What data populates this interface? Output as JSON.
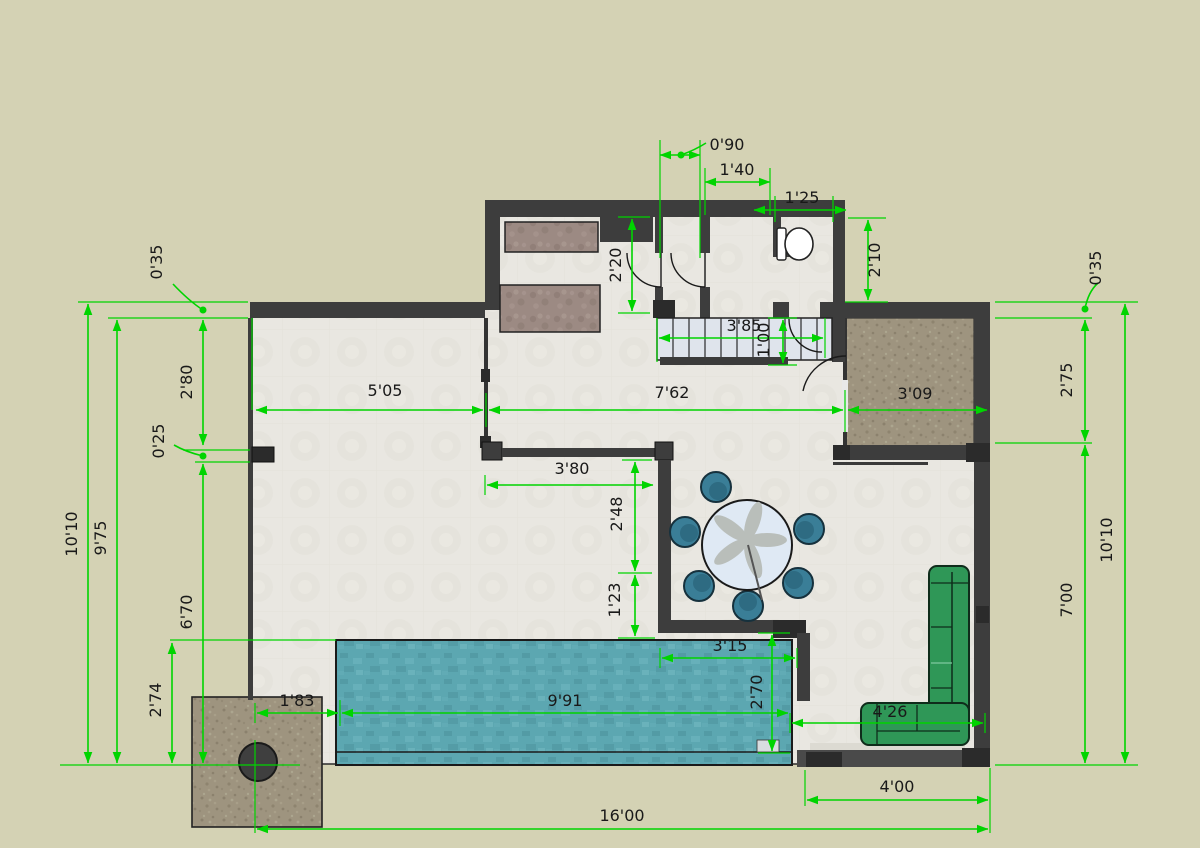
{
  "drawing": {
    "kind": "floor-plan",
    "style": "sketchup-dimensioned-plan"
  },
  "dimensions": {
    "top_offset": "0'90",
    "top_hall_width": "1'40",
    "top_bath_width": "1'25",
    "kitchen_depth": "2'20",
    "bath_depth": "2'10",
    "left_wall_thickness": "0'35",
    "left_upper_span": "2'80",
    "left_pier": "0'25",
    "left_lower_span": "6'70",
    "left_bottom_span": "2'74",
    "left_inner_height": "9'75",
    "left_outer_height": "10'10",
    "width_left": "5'05",
    "width_middle": "7'62",
    "width_right": "3'09",
    "stairs_width": "3'85",
    "stairs_run": "1'00",
    "dining_wall_width": "3'80",
    "dining_upper_span": "2'48",
    "dining_lower_span": "1'23",
    "pool_inner_width": "3'15",
    "pool_depth": "2'70",
    "pool_left_offset": "1'83",
    "pool_length": "9'91",
    "sofa_span": "4'26",
    "right_upper_span": "2'75",
    "right_wall_thickness": "0'35",
    "right_lower_span": "7'00",
    "right_outer_height": "10'10",
    "bottom_right_span": "4'00",
    "bottom_total_width": "16'00"
  },
  "colors": {
    "background": "#d4d2b4",
    "floor": "#e9e7e1",
    "wall": "#3d3d3d",
    "dimension_green": "#00d400",
    "pool_water": "#5ca7b1",
    "terrace_brown": "#9e947f",
    "sofa_green": "#2f9757",
    "chair_teal": "#3a7e97",
    "table_top": "#dfe9f4",
    "counter": "#9c8a83",
    "stairs": "#dfe4ec"
  }
}
